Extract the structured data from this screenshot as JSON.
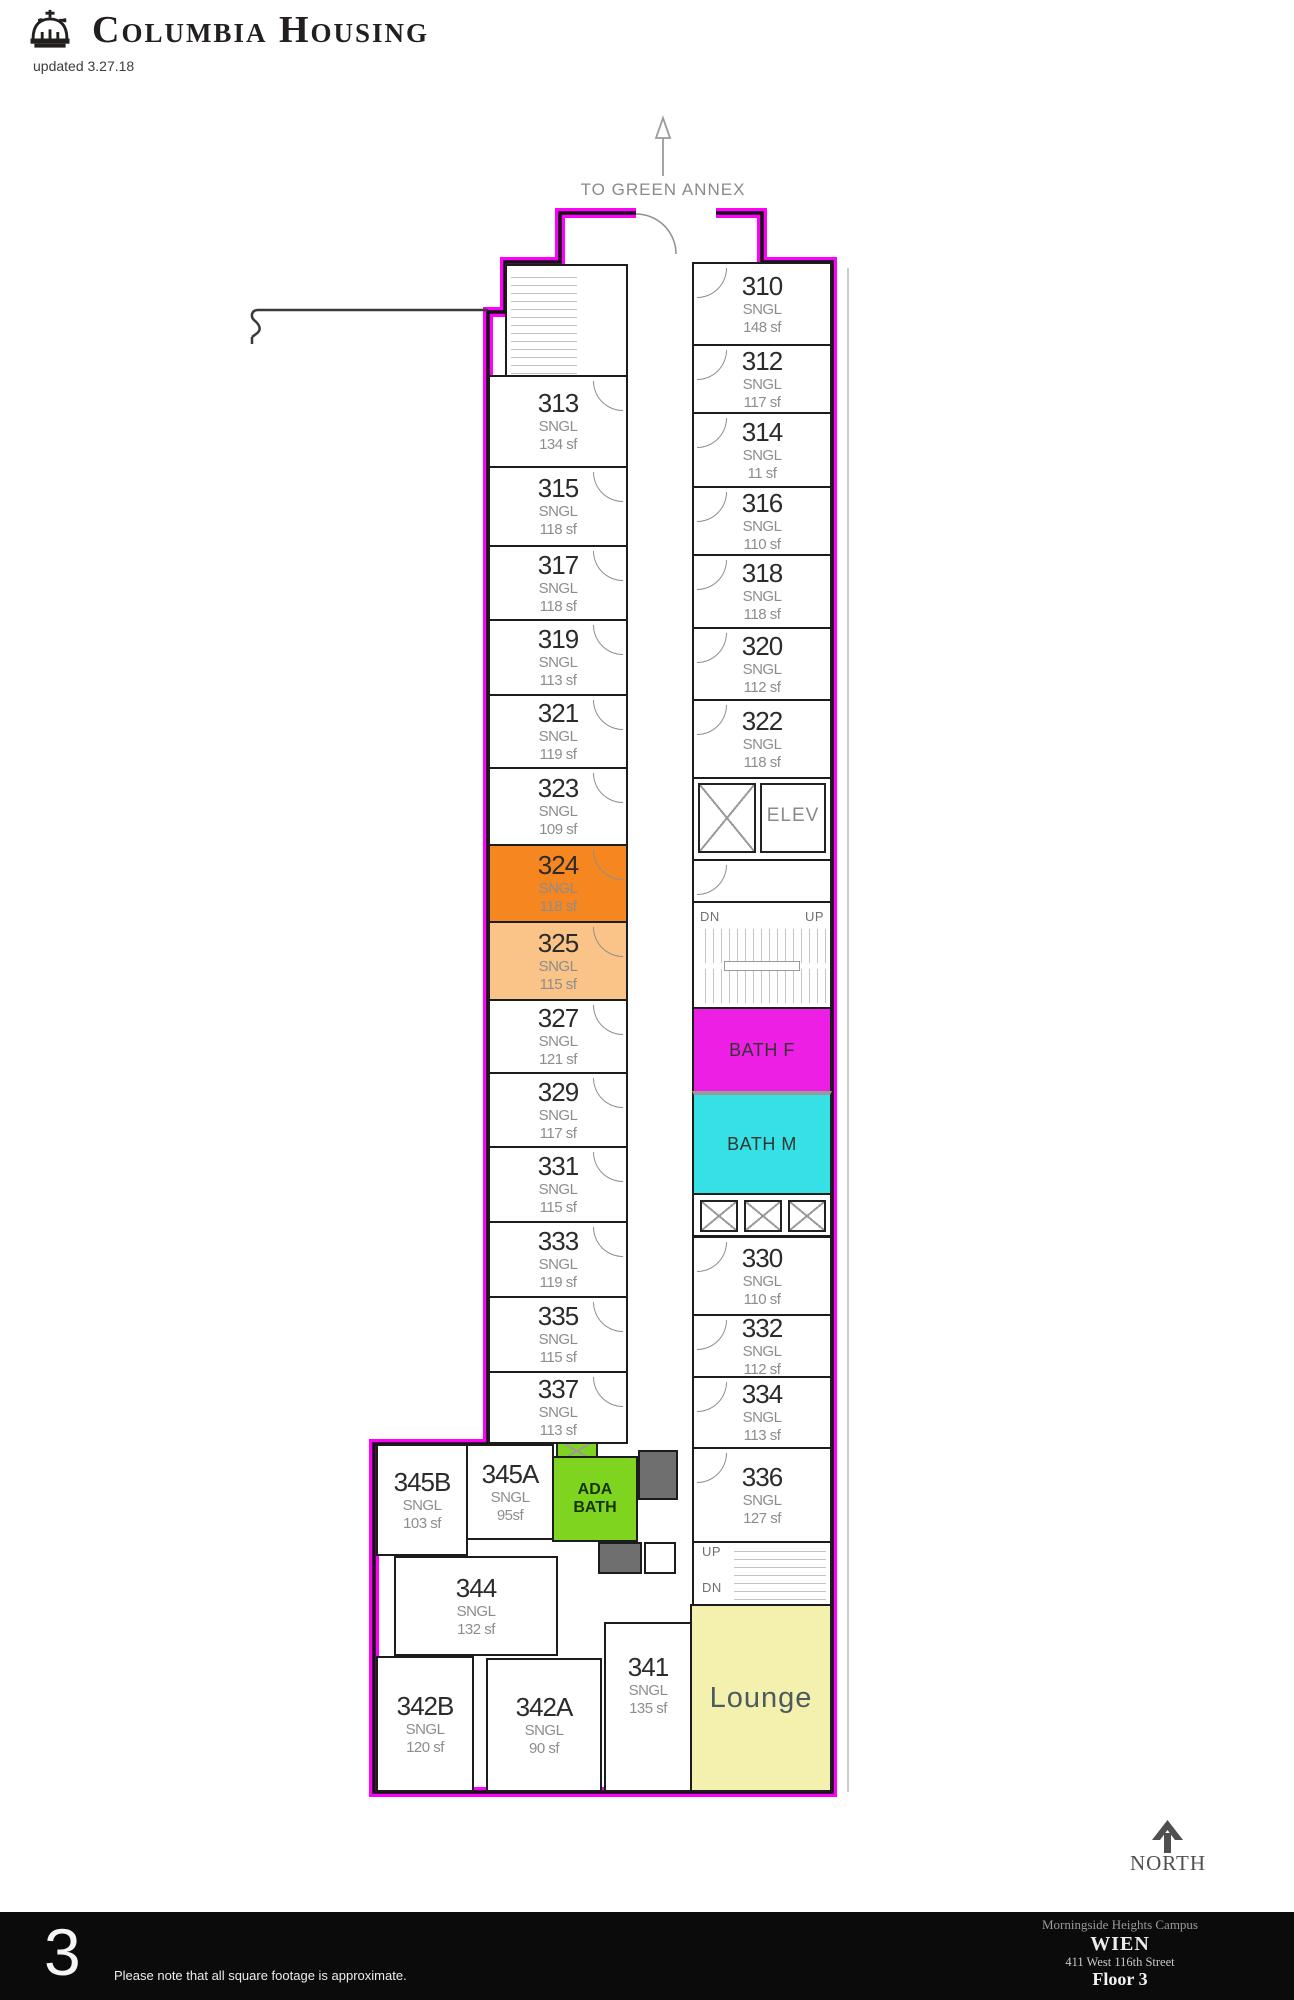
{
  "header": {
    "brand": "Columbia Housing",
    "updated": "updated 3.27.18"
  },
  "plan": {
    "annex_label": "TO GREEN ANNEX",
    "north_label": "NORTH",
    "elev_label": "ELEV",
    "up_label": "UP",
    "dn_label": "DN",
    "rooms_left": [
      {
        "number": "313",
        "type": "SNGL",
        "size": "134 sf"
      },
      {
        "number": "315",
        "type": "SNGL",
        "size": "118 sf"
      },
      {
        "number": "317",
        "type": "SNGL",
        "size": "118 sf"
      },
      {
        "number": "319",
        "type": "SNGL",
        "size": "113 sf"
      },
      {
        "number": "321",
        "type": "SNGL",
        "size": "119 sf"
      },
      {
        "number": "323",
        "type": "SNGL",
        "size": "109 sf"
      },
      {
        "number": "324",
        "type": "SNGL",
        "size": "118 sf"
      },
      {
        "number": "325",
        "type": "SNGL",
        "size": "115 sf"
      },
      {
        "number": "327",
        "type": "SNGL",
        "size": "121 sf"
      },
      {
        "number": "329",
        "type": "SNGL",
        "size": "117 sf"
      },
      {
        "number": "331",
        "type": "SNGL",
        "size": "115 sf"
      },
      {
        "number": "333",
        "type": "SNGL",
        "size": "119 sf"
      },
      {
        "number": "335",
        "type": "SNGL",
        "size": "115 sf"
      },
      {
        "number": "337",
        "type": "SNGL",
        "size": "113 sf"
      }
    ],
    "rooms_right": [
      {
        "number": "310",
        "type": "SNGL",
        "size": "148 sf"
      },
      {
        "number": "312",
        "type": "SNGL",
        "size": "117 sf"
      },
      {
        "number": "314",
        "type": "SNGL",
        "size": "11 sf"
      },
      {
        "number": "316",
        "type": "SNGL",
        "size": "110 sf"
      },
      {
        "number": "318",
        "type": "SNGL",
        "size": "118 sf"
      },
      {
        "number": "320",
        "type": "SNGL",
        "size": "112 sf"
      },
      {
        "number": "322",
        "type": "SNGL",
        "size": "118 sf"
      },
      {
        "number": "330",
        "type": "SNGL",
        "size": "110 sf"
      },
      {
        "number": "332",
        "type": "SNGL",
        "size": "112 sf"
      },
      {
        "number": "334",
        "type": "SNGL",
        "size": "113 sf"
      },
      {
        "number": "336",
        "type": "SNGL",
        "size": "127 sf"
      }
    ],
    "rooms_bottom": [
      {
        "number": "345B",
        "type": "SNGL",
        "size": "103 sf"
      },
      {
        "number": "345A",
        "type": "SNGL",
        "size": "95sf"
      },
      {
        "number": "344",
        "type": "SNGL",
        "size": "132 sf"
      },
      {
        "number": "342B",
        "type": "SNGL",
        "size": "120 sf"
      },
      {
        "number": "342A",
        "type": "SNGL",
        "size": "90 sf"
      },
      {
        "number": "341",
        "type": "SNGL",
        "size": "135 sf"
      }
    ],
    "special": {
      "bath_f": "BATH F",
      "bath_m": "BATH M",
      "ada_bath_line1": "ADA",
      "ada_bath_line2": "BATH",
      "lounge": "Lounge"
    },
    "colors": {
      "wall_highlight": "#ff00fb",
      "room_324": "#f6861f",
      "room_325": "#fac488",
      "bath_f": "#ee1fe4",
      "bath_m": "#35e1e4",
      "ada_bath": "#7fd41f",
      "lounge": "#f4f0ad"
    }
  },
  "footer": {
    "page_number": "3",
    "note": "Please note that all square footage is approximate.",
    "campus": "Morningside Heights Campus",
    "building": "WIEN",
    "address": "411 West 116th Street",
    "floor": "Floor 3"
  }
}
